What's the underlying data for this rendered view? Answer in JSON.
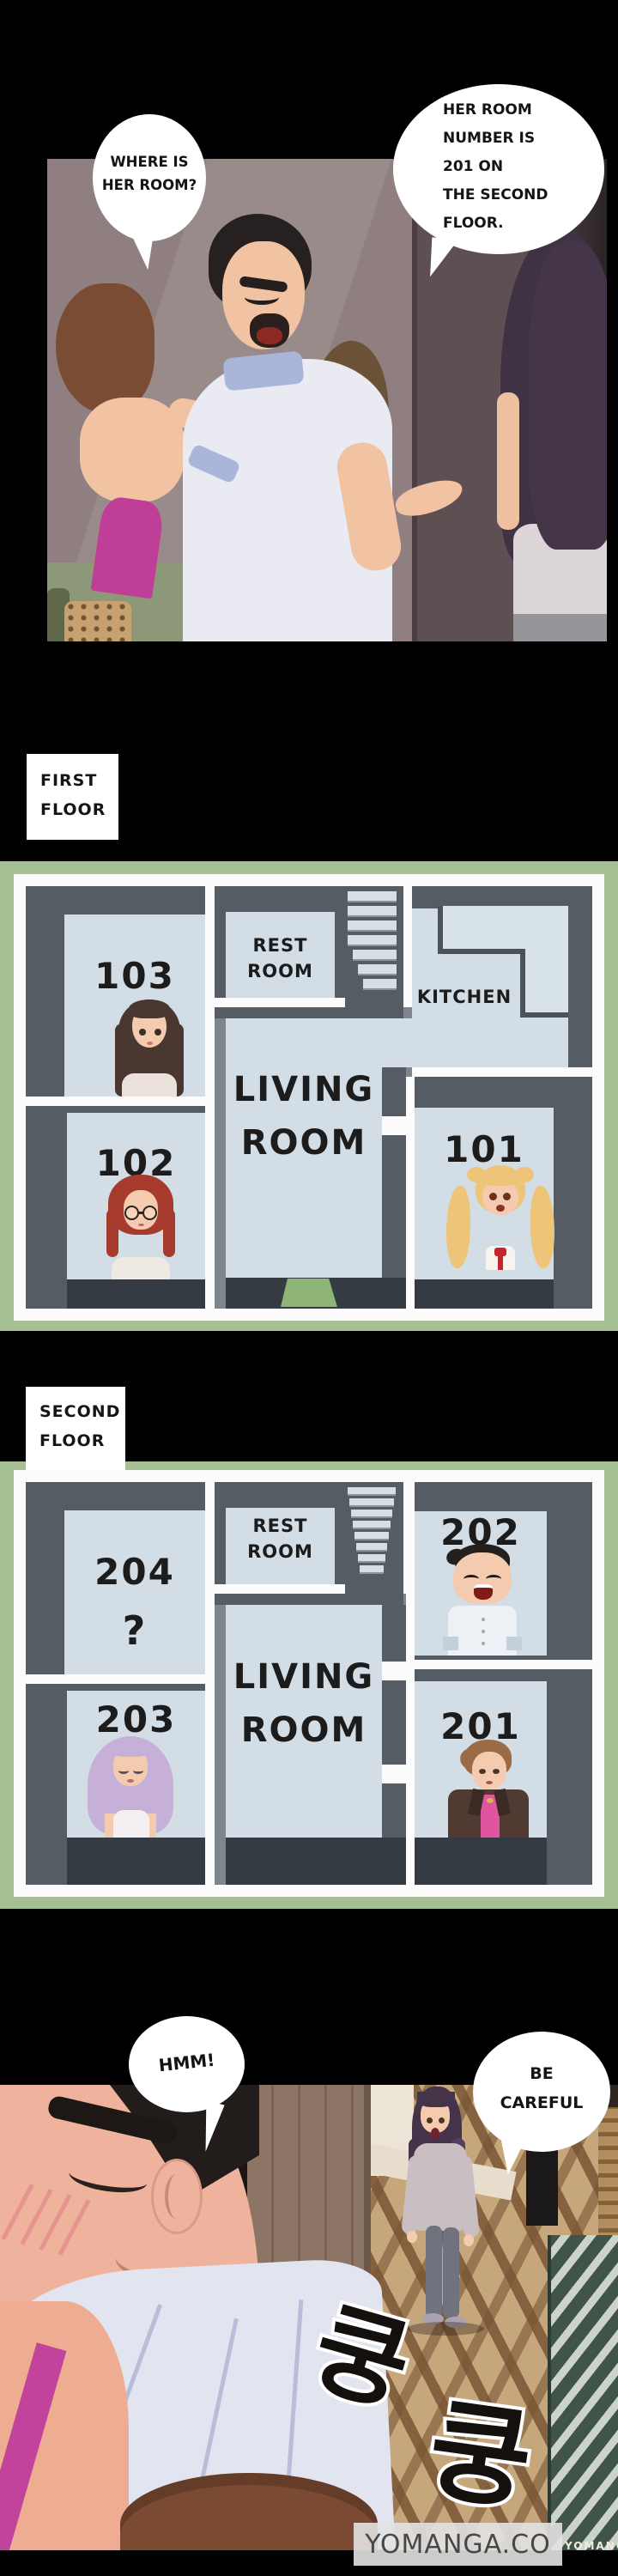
{
  "top_panel": {
    "bubble_left": {
      "lines": [
        "WHERE IS",
        "HER ROOM?"
      ]
    },
    "bubble_right": {
      "lines": [
        "HER ROOM",
        "NUMBER IS",
        "201 ON",
        "THE SECOND",
        "FLOOR."
      ]
    }
  },
  "first_floor": {
    "label": {
      "lines": [
        "FIRST",
        "FLOOR"
      ]
    },
    "rooms": {
      "r103": "103",
      "r102": "102",
      "r101": "101",
      "rest": [
        "REST",
        "ROOM"
      ],
      "kitchen": "KITCHEN",
      "living": [
        "LIVING",
        "ROOM"
      ]
    }
  },
  "second_floor": {
    "label": {
      "lines": [
        "SECOND",
        "FLOOR"
      ]
    },
    "rooms": {
      "r204": "204",
      "r204_note": "?",
      "r203": "203",
      "r202": "202",
      "r201": "201",
      "rest": [
        "REST",
        "ROOM"
      ],
      "living": [
        "LIVING",
        "ROOM"
      ]
    }
  },
  "bottom_panel": {
    "bubble_hmm": "HMM!",
    "bubble_careful": {
      "lines": [
        "BE",
        "CAREFUL"
      ]
    },
    "sfx": [
      "쿵",
      "쿵"
    ],
    "watermark": {
      "main": "YOMANGA.CO",
      "side": "YOMANGA"
    }
  },
  "colors": {
    "frame_green": "#a6bf94",
    "room_fill": "#d2dde5",
    "wall_grey": "#7f858d",
    "wall_dark": "#565c64",
    "floor_dark": "#353b42",
    "doormat_green": "#8fb576"
  }
}
